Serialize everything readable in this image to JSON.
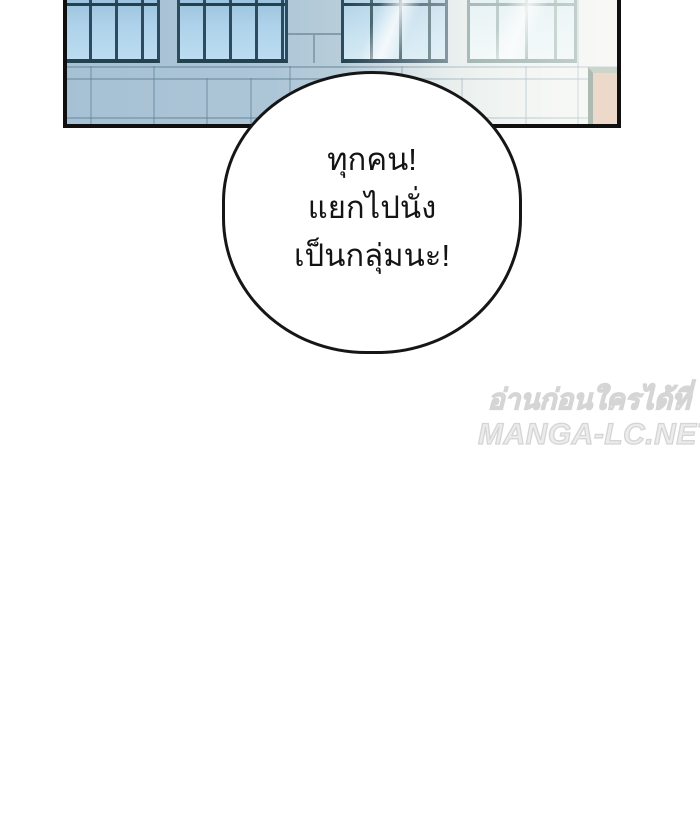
{
  "panel": {
    "kind": "manga-panel-building-facade",
    "colors": {
      "outline": "#101010",
      "glass_blue": "#aed3ea",
      "glass_light": "#e2f1f4",
      "mullion_dark": "#2c4b5e",
      "mullion_light": "#7d9c96",
      "wall_blue": "#a9c4d6",
      "wall_white": "#f1f3ef",
      "door_beige": "#ecd9c9"
    }
  },
  "speech_bubble": {
    "fill": "#ffffff",
    "stroke": "#161616",
    "lines": [
      "ทุกคน!",
      "แยกไปนั่ง",
      "เป็นกลุ่มนะ!"
    ]
  },
  "watermark": {
    "line1": "อ่านก่อนใครได้ที่",
    "line2": "MANGA-LC.NET",
    "color": "#dedede"
  }
}
